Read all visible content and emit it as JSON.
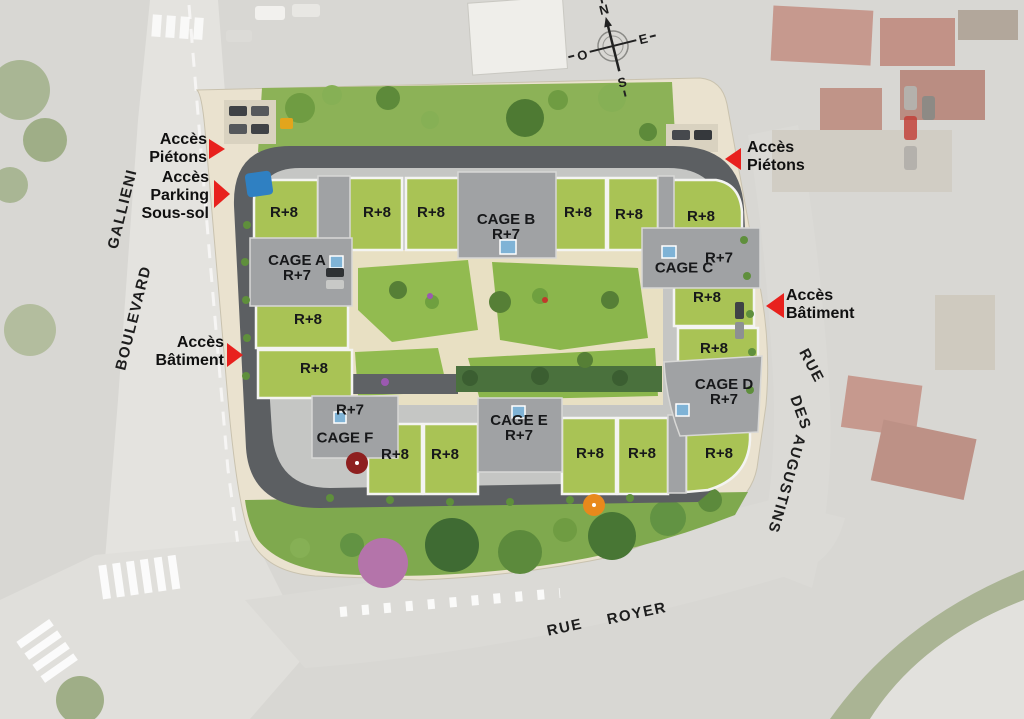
{
  "compass": {
    "north": "N",
    "east": "E",
    "south": "S",
    "west": "O"
  },
  "streets": {
    "boulevard": "BOULEVARD",
    "gallieni": "GALLIENI",
    "rue_side": "RUE",
    "des": "DES",
    "augustins": "AUGUSTINS",
    "rue_bottom": "RUE",
    "royer": "ROYER"
  },
  "accesses": {
    "pietons_left": "Accès\nPiétons",
    "parking_left": "Accès\nParking\nSous-sol",
    "batiment_left": "Accès\nBâtiment",
    "pietons_right": "Accès\nPiétons",
    "batiment_right": "Accès\nBâtiment"
  },
  "cages": {
    "a": "CAGE A\nR+7",
    "b": "CAGE B\nR+7",
    "c": "CAGE C",
    "c_level": "R+7",
    "d": "CAGE D\nR+7",
    "e": "CAGE E\nR+7",
    "f": "CAGE F",
    "f_level": "R+7"
  },
  "r8_labels": [
    "R+8",
    "R+8",
    "R+8",
    "R+8",
    "R+8",
    "R+8",
    "R+8",
    "R+8",
    "R+8",
    "R+8",
    "R+8",
    "R+8",
    "R+8",
    "R+8",
    "R+8"
  ],
  "colors": {
    "access_red": "#e8211d",
    "roof_green": "#a9c355",
    "roof_gray": "#a0a2a4",
    "ring_road": "#5c5f62",
    "lawn_green": "#90ba4e",
    "path_beige": "#e8e0c3",
    "sidewalk_beige": "#eae2cf"
  }
}
